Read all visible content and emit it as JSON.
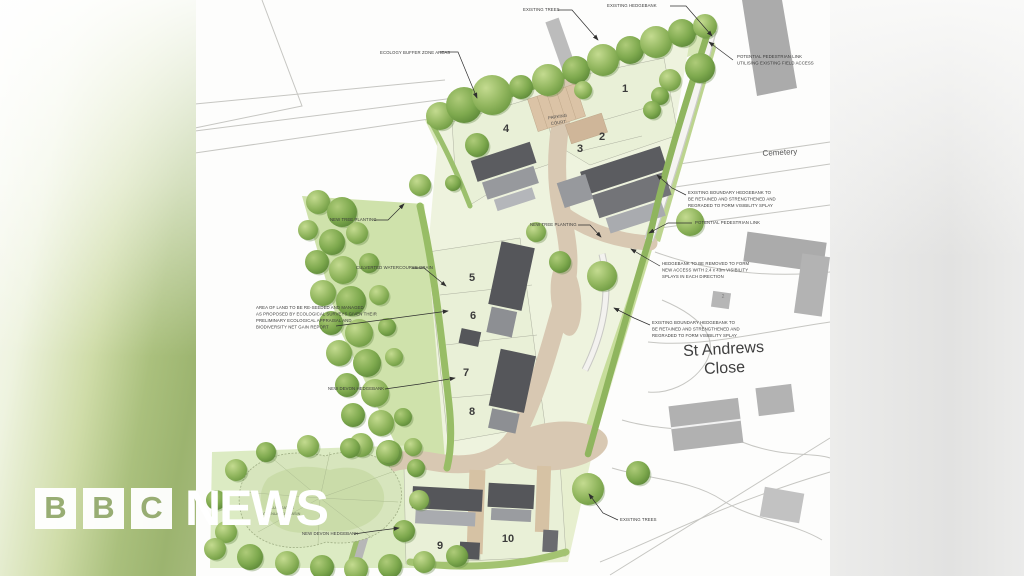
{
  "branding": {
    "logo_letters": [
      "B",
      "B",
      "C"
    ],
    "logo_word": "NEWS"
  },
  "map": {
    "area_labels": {
      "cemetery": "Cemetery",
      "street_line1": "St Andrews",
      "street_line2": "Close",
      "parking_line1": "PARKING",
      "parking_line2": "COURT",
      "pond_line1": "ILLUSTRATIVE",
      "pond_line2": "ATTENUATION BASIN",
      "existing_house_number": "2"
    },
    "plots": [
      "1",
      "2",
      "3",
      "4",
      "5",
      "6",
      "7",
      "8",
      "9",
      "10"
    ],
    "annotations": [
      {
        "lines": [
          "ECOLOGY BUFFER ZONE AREAS"
        ]
      },
      {
        "lines": [
          "EXISTING TREES"
        ]
      },
      {
        "lines": [
          "EXISTING HEDGEBANK"
        ]
      },
      {
        "lines": [
          "POTENTIAL PEDESTRIAN LINK",
          "UTILISING EXISTING FIELD ACCESS"
        ]
      },
      {
        "lines": [
          "EXISTING BOUNDARY HEDGEBANK TO",
          "BE RETAINED AND STRENGTHENED AND",
          "REGRADED TO FORM VISIBILITY SPLAY"
        ]
      },
      {
        "lines": [
          "POTENTIAL PEDESTRIAN LINK"
        ]
      },
      {
        "lines": [
          "HEDGEBANK TO BE REMOVED TO FORM",
          "NEW ACCESS WITH 2.4 x 43m VISIBILITY",
          "SPLAYS IN EACH DIRECTION"
        ]
      },
      {
        "lines": [
          "EXISTING BOUNDARY HEDGEBANK TO",
          "BE RETAINED AND STRENGTHENED AND",
          "REGRADED TO FORM VISIBILITY SPLAY"
        ]
      },
      {
        "lines": [
          "NEW TREE PLANTING"
        ]
      },
      {
        "lines": [
          "CULVERTED WATERCOURSE DRAIN"
        ]
      },
      {
        "lines": [
          "AREA OF LAND TO BE RE-SEEDED AND MANAGED",
          "AS PROPOSED BY ECOLOGICAL SURVEYS GIVEN THEIR",
          "PRELIMINARY ECOLOGICAL APPRAISAL AND",
          "BIODIVERSITY NET GAIN REPORT"
        ]
      },
      {
        "lines": [
          "NEW TREE PLANTING"
        ]
      },
      {
        "lines": [
          "NEW DEVON HEDGEBANK"
        ]
      },
      {
        "lines": [
          "EXISTING TREES"
        ]
      },
      {
        "lines": [
          "NEW DEVON HEDGEBANK"
        ]
      }
    ],
    "colors": {
      "plot_green": "#e9f0d7",
      "hedge_green": "#8fb55e",
      "road_beige": "#d8c8b2",
      "roof_grey": "#55565a",
      "context_grey": "#ababab"
    }
  }
}
